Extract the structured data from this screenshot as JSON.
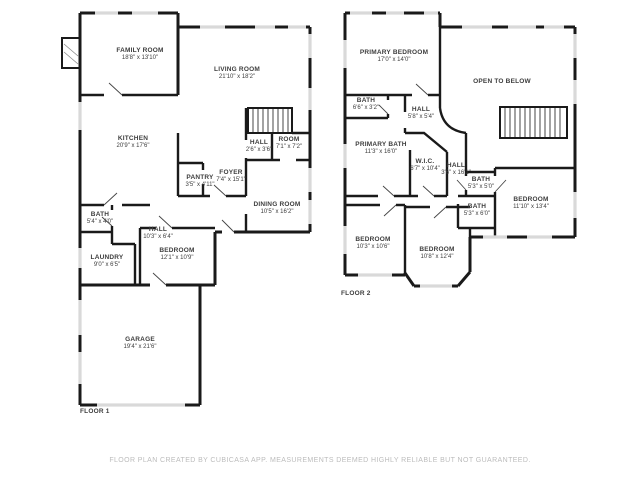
{
  "colors": {
    "background": "#ffffff",
    "wall": "#1a1a1a",
    "window": "#d9d9d9",
    "label_text": "#3d3d3d",
    "footer_text": "#bcbcbc"
  },
  "floor1": {
    "label": "FLOOR 1",
    "rooms": [
      {
        "name": "FAMILY ROOM",
        "dims": "18'8\" x 13'10\""
      },
      {
        "name": "LIVING ROOM",
        "dims": "21'10\" x 18'2\""
      },
      {
        "name": "KITCHEN",
        "dims": "20'9\" x 17'6\""
      },
      {
        "name": "PANTRY",
        "dims": "3'5\" x 4'11\""
      },
      {
        "name": "FOYER",
        "dims": "7'4\" x 15'1\""
      },
      {
        "name": "HALL",
        "dims": "2'6\" x 3'6\""
      },
      {
        "name": "ROOM",
        "dims": "7'1\" x 7'2\""
      },
      {
        "name": "DINING ROOM",
        "dims": "10'5\" x 16'2\""
      },
      {
        "name": "BATH",
        "dims": "5'4\" x 4'0\""
      },
      {
        "name": "HALL",
        "dims": "10'3\" x 6'4\""
      },
      {
        "name": "LAUNDRY",
        "dims": "9'0\" x 6'5\""
      },
      {
        "name": "BEDROOM",
        "dims": "12'1\" x 10'9\""
      },
      {
        "name": "GARAGE",
        "dims": "19'4\" x 21'6\""
      }
    ]
  },
  "floor2": {
    "label": "FLOOR 2",
    "rooms": [
      {
        "name": "PRIMARY BEDROOM",
        "dims": "17'0\" x 14'0\""
      },
      {
        "name": "OPEN TO BELOW",
        "dims": ""
      },
      {
        "name": "BATH",
        "dims": "6'6\" x 3'2\""
      },
      {
        "name": "HALL",
        "dims": "5'8\" x 5'4\""
      },
      {
        "name": "PRIMARY BATH",
        "dims": "11'3\" x 16'0\""
      },
      {
        "name": "W.I.C.",
        "dims": "6'7\" x 10'4\""
      },
      {
        "name": "HALL",
        "dims": "3'6\" x 16'1\""
      },
      {
        "name": "BATH",
        "dims": "5'3\" x 5'0\""
      },
      {
        "name": "BATH",
        "dims": "5'3\" x 6'0\""
      },
      {
        "name": "BEDROOM",
        "dims": "11'10\" x 13'4\""
      },
      {
        "name": "BEDROOM",
        "dims": "10'3\" x 10'6\""
      },
      {
        "name": "BEDROOM",
        "dims": "10'8\" x 12'4\""
      }
    ]
  },
  "footer": {
    "disclaimer": "FLOOR PLAN CREATED BY CUBICASA APP. MEASUREMENTS DEEMED HIGHLY RELIABLE BUT NOT GUARANTEED."
  }
}
